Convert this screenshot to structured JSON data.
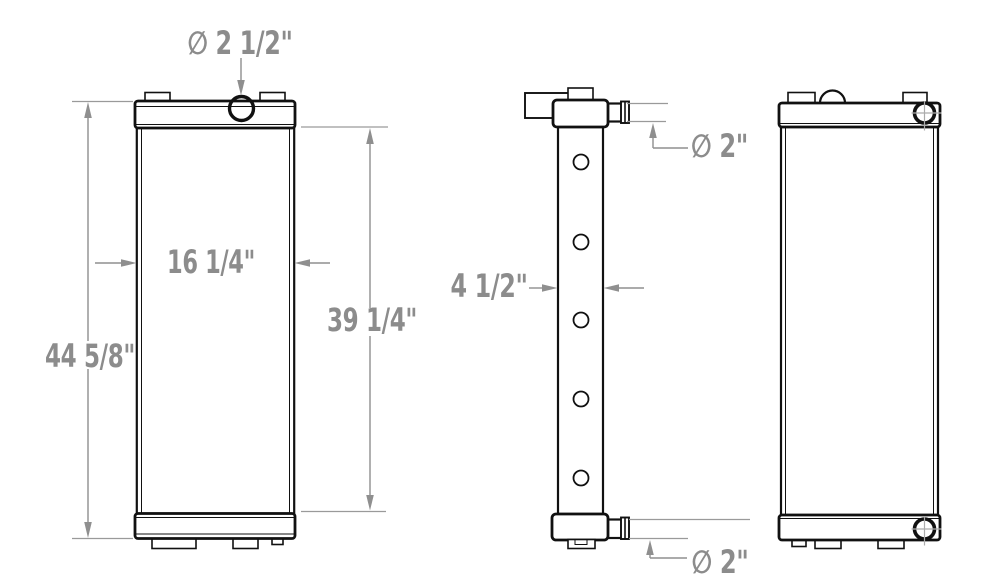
{
  "drawing": {
    "type": "radiator-technical-drawing",
    "background_color": "#ffffff",
    "linework_color": "#111111",
    "dimension_color": "#8c8c8c",
    "dimensions": {
      "filler_neck_diameter": "∅ 2 1/2\"",
      "overall_height": "44 5/8\"",
      "core_width": "16 1/4\"",
      "core_height": "39 1/4\"",
      "core_depth": "4 1/2\"",
      "top_outlet_diameter": "∅ 2\"",
      "bottom_outlet_diameter": "∅ 2\""
    }
  }
}
